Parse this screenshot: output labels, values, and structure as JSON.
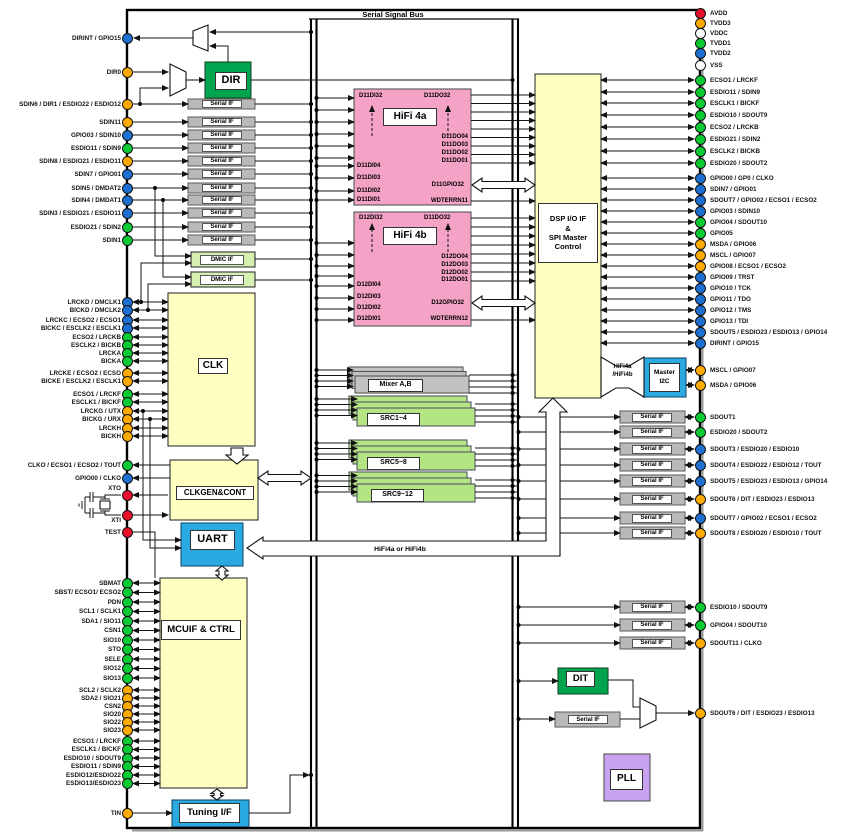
{
  "diagram": {
    "bus_label": "Serial Signal Bus",
    "hifi_bus_label": "HiFi4a or HiFi4b",
    "serial_if_label": "Serial IF",
    "dmic_label": "DMIC IF"
  },
  "blocks": {
    "dir": "DIR",
    "clk": "CLK",
    "clkgen": "CLKGEN&CONT",
    "uart": "UART",
    "mcuif": "MCUIF & CTRL",
    "tuning": "Tuning I/F",
    "hifi4a": "HiFi 4a",
    "hifi4b": "HiFi 4b",
    "mixer": "Mixer A,B",
    "src14": "SRC1~4",
    "src58": "SRC5~8",
    "src912": "SRC9~12",
    "dsp": "DSP I/O IF\n&\nSPI Master\nControl",
    "masteri2c": "Master\nI2C",
    "bridge": "HiFi4a\n/HiFi4b",
    "dit": "DIT",
    "pll": "PLL"
  },
  "hifi4a": {
    "tl": "D11DI32",
    "tr": "D11DO32",
    "right_top": [
      "D11DO04",
      "D11DO03",
      "D11DO02",
      "D11DO01"
    ],
    "left": [
      "D11DI04",
      "D11DI03",
      "D11DI02",
      "D11DI01"
    ],
    "gpio": "D11GPIO32",
    "wdt": "WDTERRN11"
  },
  "hifi4b": {
    "tl": "D12DI32",
    "tr": "D11DO32",
    "right_top": [
      "D12DO04",
      "D12DO03",
      "D12DO02",
      "D12DO01"
    ],
    "left": [
      "D12DI04",
      "D12DI03",
      "D12DI02",
      "D12DI01"
    ],
    "gpio": "D12GPIO32",
    "wdt": "WDTERRN12"
  },
  "left_pins": {
    "dir": [
      {
        "label": "DIRINT / GPIO15",
        "color": "blue"
      },
      {
        "label": "DIR0",
        "color": "orange"
      }
    ],
    "sdin": [
      {
        "label": "SDIN6 / DIR1 / ESDIO22 / ESDIO12",
        "color": "orange"
      },
      {
        "label": "SDIN11",
        "color": "orange"
      },
      {
        "label": "GPIO03 / SDIN10",
        "color": "blue"
      },
      {
        "label": "ESDIO11 / SDIN9",
        "color": "green"
      },
      {
        "label": "SDIN8 / ESDIO21 / ESDIO11",
        "color": "orange"
      },
      {
        "label": "SDIN7 / GPIO01",
        "color": "blue"
      },
      {
        "label": "SDIN5 / DMDAT2",
        "color": "blue"
      },
      {
        "label": "SDIN4 / DMDAT1",
        "color": "blue"
      },
      {
        "label": "SDIN3 / ESDIO21 / ESDIO11",
        "color": "blue"
      },
      {
        "label": "ESDIO21 / SDIN2",
        "color": "green"
      },
      {
        "label": "SDIN1",
        "color": "green"
      }
    ],
    "clk": [
      {
        "label": "LRCKD / DMCLK1",
        "color": "blue"
      },
      {
        "label": "BICKD / DMCLK2",
        "color": "blue"
      },
      {
        "label": "LRCKC / ECSO2 / ECSO1",
        "color": "blue"
      },
      {
        "label": "BICKC / ESCLK2 / ESCLK1",
        "color": "blue"
      },
      {
        "label": "ECSO2 / LRCKB",
        "color": "green"
      },
      {
        "label": "ESCLK2 / BICKB",
        "color": "green"
      },
      {
        "label": "LRCKA",
        "color": "green"
      },
      {
        "label": "BICKA",
        "color": "green"
      },
      {
        "label": "LRCKE / ECSO2 / ECSO",
        "color": "orange"
      },
      {
        "label": "BICKE / ESCLK2 / ESCLK1",
        "color": "orange"
      },
      {
        "label": "ECSO1 / LRCKF",
        "color": "green"
      },
      {
        "label": "ESCLK1 / BICKF",
        "color": "green"
      },
      {
        "label": "LRCKG / UTX",
        "color": "orange"
      },
      {
        "label": "BICKG / URX",
        "color": "orange"
      },
      {
        "label": "LRCKH",
        "color": "orange"
      },
      {
        "label": "BICKH",
        "color": "orange"
      }
    ],
    "clkgen": [
      {
        "label": "CLKO / ECSO1 / ECSO2 / TOUT",
        "color": "green"
      },
      {
        "label": "GPIO00 / CLKO",
        "color": "blue"
      }
    ],
    "xtal": [
      {
        "label": "XTO",
        "color": "red"
      },
      {
        "label": "XTI",
        "color": "red"
      },
      {
        "label": "TEST",
        "color": "red"
      }
    ],
    "mcu": [
      {
        "label": "SBMAT",
        "color": "green"
      },
      {
        "label": "SBST/ ECSO1/ ECSO2",
        "color": "green"
      },
      {
        "label": "PDN",
        "color": "green"
      },
      {
        "label": "SCL1 / SCLK1",
        "color": "green"
      },
      {
        "label": "SDA1 / SIO11",
        "color": "green"
      },
      {
        "label": "CSN1",
        "color": "green"
      },
      {
        "label": "SIO10",
        "color": "green"
      },
      {
        "label": "STO",
        "color": "green"
      },
      {
        "label": "SELE",
        "color": "green"
      },
      {
        "label": "SIO12",
        "color": "green"
      },
      {
        "label": "SIO13",
        "color": "green"
      }
    ],
    "mcu2": [
      {
        "label": "SCL2 / SCLK2",
        "color": "orange"
      },
      {
        "label": "SDA2 / SIO21",
        "color": "orange"
      },
      {
        "label": "CSN2",
        "color": "orange"
      },
      {
        "label": "SIO20",
        "color": "orange"
      },
      {
        "label": "SIO22",
        "color": "orange"
      },
      {
        "label": "SIO23",
        "color": "orange"
      }
    ],
    "esd": [
      {
        "label": "ECSO1 / LRCKF",
        "color": "green"
      },
      {
        "label": "ESCLK1 / BICKF",
        "color": "green"
      },
      {
        "label": "ESDIO10 / SDOUT9",
        "color": "green"
      },
      {
        "label": "ESDIO11 / SDIN9",
        "color": "green"
      },
      {
        "label": "ESDIO12/ESDIO22",
        "color": "green"
      },
      {
        "label": "ESDIO13/ESDIO23",
        "color": "green"
      }
    ],
    "tin": [
      {
        "label": "TIN",
        "color": "orange"
      }
    ]
  },
  "right_pins": {
    "power": [
      {
        "label": "AVDD",
        "color": "red"
      },
      {
        "label": "TVDD3",
        "color": "orange"
      },
      {
        "label": "VDDC",
        "color": "white"
      },
      {
        "label": "TVDD1",
        "color": "green"
      },
      {
        "label": "TVDD2",
        "color": "blue"
      },
      {
        "label": "VSS",
        "color": "white"
      }
    ],
    "eport": [
      {
        "label": "ECSO1 / LRCKF",
        "color": "green"
      },
      {
        "label": "ESDIO11 / SDIN9",
        "color": "green"
      },
      {
        "label": "ESCLK1 / BICKF",
        "color": "green"
      },
      {
        "label": "ESDIO10 / SDOUT9",
        "color": "green"
      },
      {
        "label": "ECSO2 / LRCKB",
        "color": "green"
      },
      {
        "label": "ESDIO21 / SDIN2",
        "color": "green"
      },
      {
        "label": "ESCLK2 / BICKB",
        "color": "green"
      },
      {
        "label": "ESDIO20 / SDOUT2",
        "color": "green"
      }
    ],
    "gpio": [
      {
        "label": "GPIO00 / GP0 / CLKO",
        "color": "blue"
      },
      {
        "label": "SDIN7 / GPIO01",
        "color": "blue"
      },
      {
        "label": "SDOUT7 / GPIO02 / ECSO1 / ECSO2",
        "color": "blue"
      },
      {
        "label": "GPIO03 / SDIN10",
        "color": "blue"
      },
      {
        "label": "GPIO04 / SDOUT10",
        "color": "green"
      },
      {
        "label": "GPIO05",
        "color": "green"
      },
      {
        "label": "MSDA / GPIO06",
        "color": "orange"
      },
      {
        "label": "MSCL / GPIO07",
        "color": "orange"
      },
      {
        "label": "GPIO08 / ECSO1 / ECSO2",
        "color": "orange"
      },
      {
        "label": "GPIO09 / TRST",
        "color": "blue"
      },
      {
        "label": "GPIO10 / TCK",
        "color": "blue"
      },
      {
        "label": "GPIO11 / TDO",
        "color": "blue"
      },
      {
        "label": "GPIO12 / TMS",
        "color": "blue"
      },
      {
        "label": "GPIO13 / TDI",
        "color": "blue"
      },
      {
        "label": "SDOUT5 / ESDIO23 / ESDIO13 / GPIO14",
        "color": "blue"
      },
      {
        "label": "DIRINT / GPIO15",
        "color": "blue"
      }
    ],
    "i2c": [
      {
        "label": "MSCL / GPIO07",
        "color": "orange"
      },
      {
        "label": "MSDA / GPIO06",
        "color": "orange"
      }
    ],
    "sdout": [
      {
        "label": "SDOUT1",
        "color": "green"
      },
      {
        "label": "ESDIO20 / SDOUT2",
        "color": "green"
      },
      {
        "label": "SDOUT3 / ESDIO20 / ESDIO10",
        "color": "blue"
      },
      {
        "label": "SDOUT4 / ESDIO22 / ESDIO12 / TOUT",
        "color": "blue"
      },
      {
        "label": "SDOUT5 / ESDIO23 / ESDIO13 / GPIO14",
        "color": "blue"
      },
      {
        "label": "SDOUT6 / DIT / ESDIO23 / ESDIO13",
        "color": "orange"
      },
      {
        "label": "SDOUT7 / GPIO02 / ECSO1 / ECSO2",
        "color": "blue"
      },
      {
        "label": "SDOUT8 / ESDIO20 / ESDIO10 / TOUT",
        "color": "orange"
      }
    ],
    "sdout2": [
      {
        "label": "ESDIO10 / SDOUT9",
        "color": "green"
      },
      {
        "label": "GPIO04 / SDOUT10",
        "color": "green"
      },
      {
        "label": "SDOUT11 / CLKO",
        "color": "orange"
      }
    ],
    "dit": [
      {
        "label": "SDOUT6 / DIT / ESDIO23 / ESDIO13",
        "color": "orange"
      }
    ]
  },
  "colors": {
    "pin": {
      "red": "#E8112D",
      "orange": "#FFAA00",
      "green": "#0ACB33",
      "blue": "#1E6FD2",
      "white": "#FFFFFF"
    },
    "block": {
      "yellow": "#FFFFC2",
      "pink": "#F4A2C6",
      "greenblk": "#00A44F",
      "dmic": "#D6F0B2",
      "src": "#B4E583",
      "cyan": "#2BAAE2",
      "gray": "#B9B9B9",
      "mixer": "#C2C2C2",
      "purple": "#C9A3F2"
    }
  }
}
